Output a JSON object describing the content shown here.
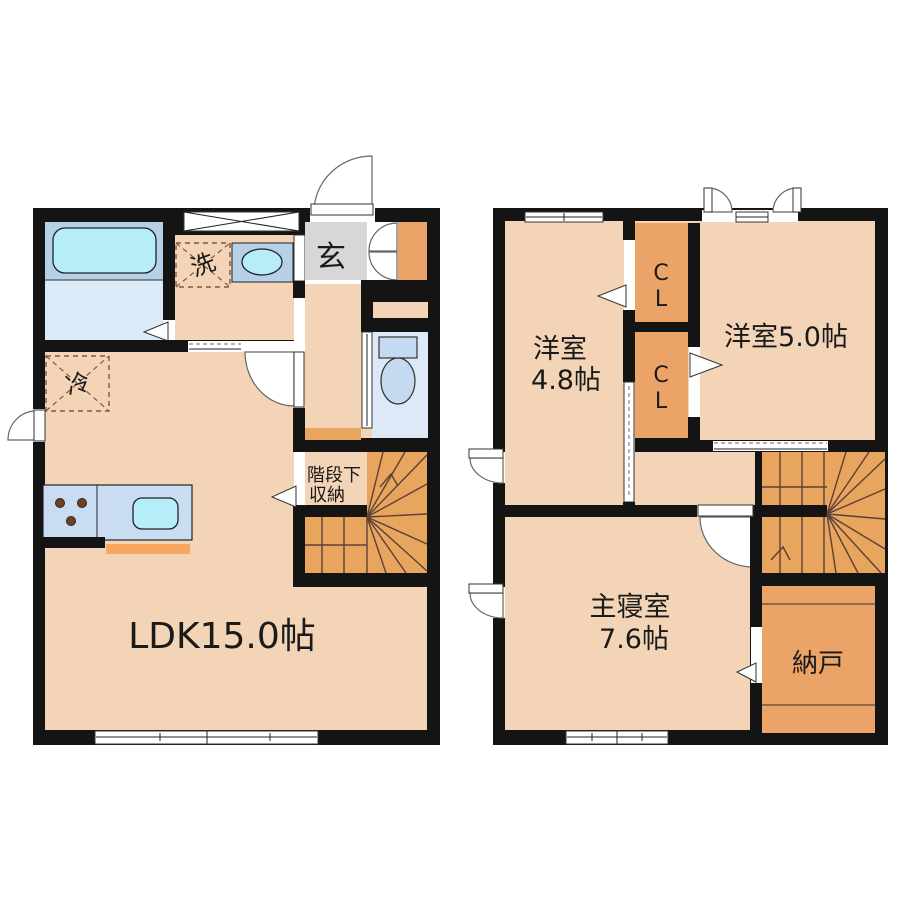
{
  "palette": {
    "wall": "#141414",
    "floor_peach": "#f3d4b6",
    "closet_orange": "#eba368",
    "stair_orange": "#e7a55e",
    "genkan_gray": "#d7d7d7",
    "bath_blue": "#b6d0e7",
    "water_cyan": "#b5eef8",
    "bath_floor_blue": "#dbeaf7",
    "counter_blue": "#c9dcf2",
    "toilet_floor_blue": "#dde9f6",
    "fixture_blue": "#c5daf1",
    "kitchen_strip_orange": "#f5a763",
    "burner_brown": "#6b4226",
    "tread_line": "#5d4037"
  },
  "floor1": {
    "labels": {
      "ldk": "LDK15.0帖",
      "entrance": "玄",
      "laundry": "洗",
      "refrigerator": "冷",
      "under_stair_storage_line1": "階段下",
      "under_stair_storage_line2": "収納"
    }
  },
  "floor2": {
    "labels": {
      "western_room_48_line1": "洋室",
      "western_room_48_line2": "4.8帖",
      "western_room_50": "洋室5.0帖",
      "closet_upper_line1": "C",
      "closet_upper_line2": "L",
      "closet_lower_line1": "C",
      "closet_lower_line2": "L",
      "master_bedroom_line1": "主寝室",
      "master_bedroom_line2": "7.6帖",
      "storage_room": "納戸"
    }
  }
}
